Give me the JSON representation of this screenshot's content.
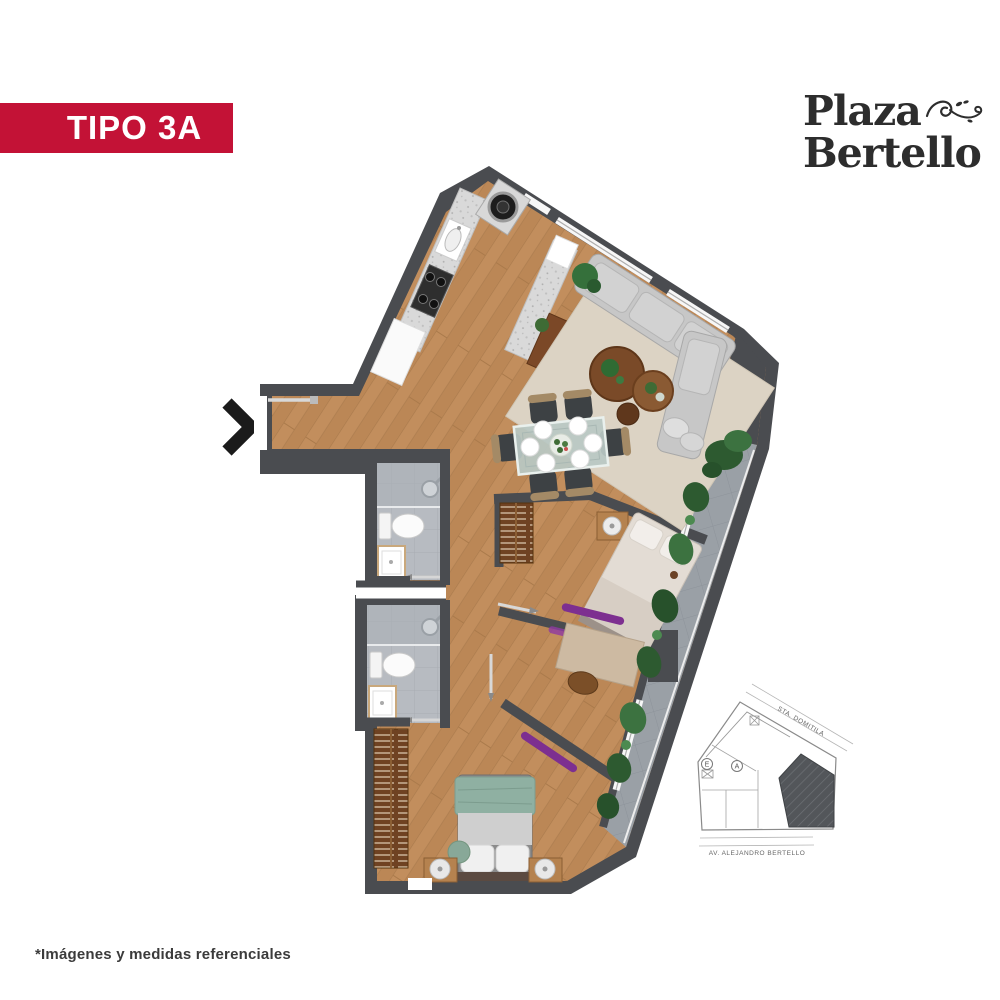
{
  "header": {
    "unit_type_label": "TIPO 3A"
  },
  "logo": {
    "line1": "Plaza",
    "line2": "Bertello"
  },
  "footnote": {
    "text": "*Imágenes y medidas referenciales"
  },
  "site_plan": {
    "street_top_label": "STA. DOMITILA",
    "street_bottom_label": "AV. ALEJANDRO BERTELLO",
    "markers": [
      {
        "label": "E"
      },
      {
        "label": "A"
      }
    ]
  },
  "palette": {
    "accent_red": "#C31236",
    "wall_gray": "#4A4C50",
    "wood_floor": "#C28E5D",
    "bath_tile": "#B7BBC1",
    "balcony_tile": "#9AA0A6",
    "rug_beige": "#DCD3C4",
    "sofa_gray": "#C7C7C7",
    "plant_green": "#35703B",
    "closet_wood": "#6F4222",
    "bed_green": "#8FB0A2",
    "accent_purple": "#7D2F90",
    "logo_ink": "#2D2D2D",
    "text_dark": "#3B3B3B"
  },
  "icons": {
    "entrance_arrow": "chevron-right-icon",
    "logo_flourish": "ornamental-flourish-icon"
  }
}
